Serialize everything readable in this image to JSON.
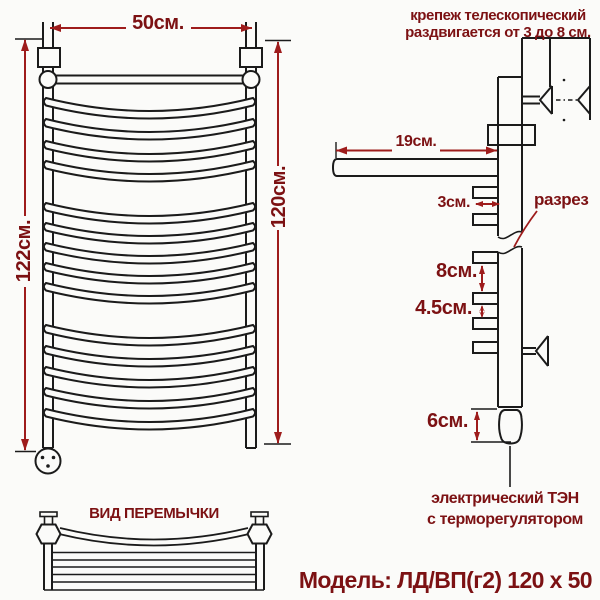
{
  "note_telescopic": {
    "line1": "крепеж телескопический",
    "line2": "раздвигается от 3 до 8 см."
  },
  "front_view": {
    "dim_width": "50см.",
    "dim_height_overall": "122см.",
    "dim_height_rail": "120см."
  },
  "side_view": {
    "dim_shelf_depth": "19см.",
    "dim_rung_offset": "3см.",
    "section_label": "разрез",
    "dim_gap_large": "8см.",
    "dim_gap_medium": "4.5см.",
    "dim_heater": "6см.",
    "heater_label_line1": "электрический ТЭН",
    "heater_label_line2": "с терморегулятором"
  },
  "bottom_view": {
    "title": "ВИД ПЕРЕМЫЧКИ"
  },
  "footer": {
    "model": "Модель: ЛД/ВП(г2) 120 х 50"
  },
  "colors": {
    "line": "#1b1b1b",
    "text": "#7c1113",
    "dimension": "#9e1c1c"
  }
}
